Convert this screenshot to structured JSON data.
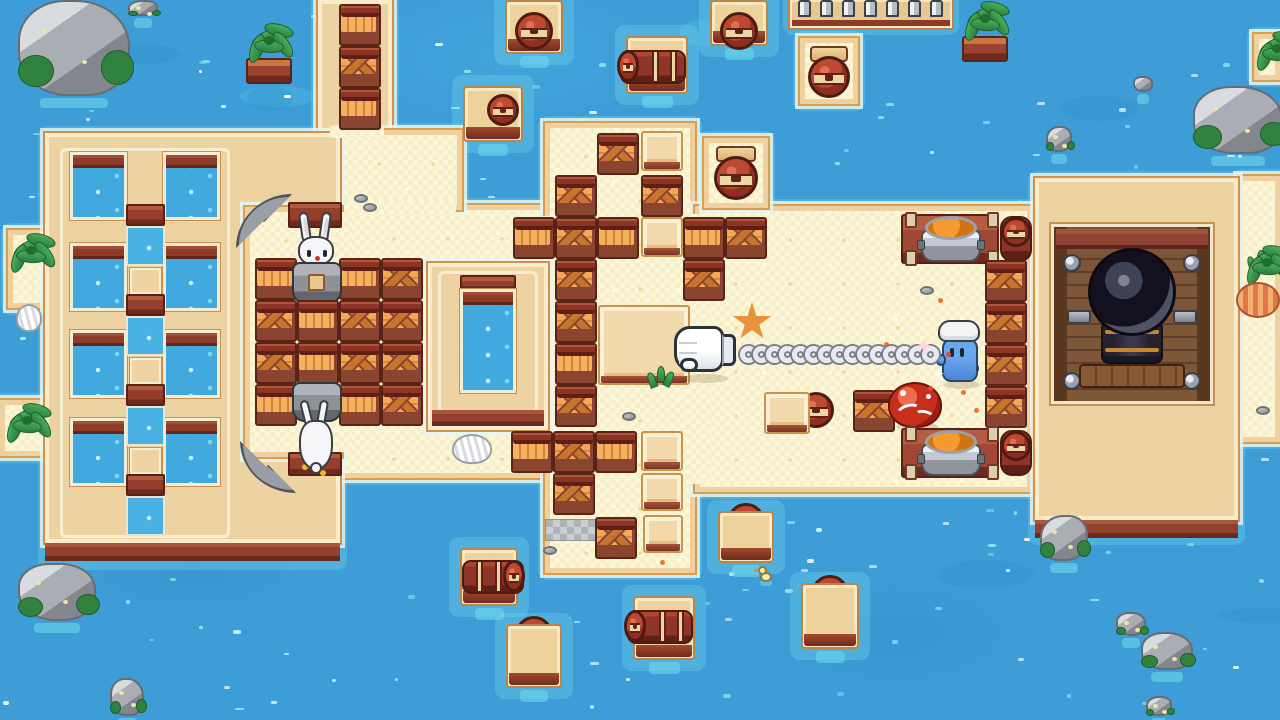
{
  "meta": {
    "scene": "pixel-art island battle arena over water",
    "hud_text": "none"
  },
  "palette": {
    "water": "#3e9dd6",
    "water_light": "#6ed0ea",
    "sand": "#f7efc8",
    "sand_edge": "#efd0a0",
    "platform_tan": "#eed3a2",
    "platform_border": "#f8eccb",
    "outline_orange": "#d2904a",
    "wall_red": "#93402e",
    "crate_frame": "#8a4530",
    "crate_plank": "#f0a452",
    "barrel_red": "#8e3428",
    "barrel_strap": "#ecd7a4",
    "rock_gray": "#aaadb3",
    "moss_green": "#31813f",
    "rabbit_white": "#f6f6f8",
    "chef_blue": "#5c9ee2",
    "crab_red": "#c62f1b",
    "soup_orange": "#f49a30",
    "cannon_dark": "#131020",
    "chain_silver": "#e8eaf0"
  },
  "land": {
    "sands": [
      [
        245,
        205,
        300,
        273
      ],
      [
        338,
        130,
        124,
        80
      ],
      [
        545,
        123,
        150,
        450
      ],
      [
        695,
        206,
        337,
        286
      ],
      [
        1238,
        176,
        42,
        266
      ]
    ],
    "sand_patches": [
      [
        538,
        216,
        20,
        256
      ],
      [
        686,
        214,
        26,
        270
      ],
      [
        344,
        200,
        112,
        16
      ],
      [
        330,
        126,
        54,
        12
      ],
      [
        334,
        212,
        18,
        240
      ]
    ],
    "pads": [
      [
        704,
        138,
        64,
        70
      ],
      [
        800,
        38,
        58,
        66
      ],
      [
        8,
        230,
        44,
        78
      ],
      [
        0,
        400,
        52,
        56
      ],
      [
        1254,
        34,
        26,
        46
      ]
    ],
    "notch": [
      245,
      207,
      97,
      250
    ],
    "dock": {
      "x": 45,
      "y": 133,
      "w": 295,
      "h": 410,
      "base_h": 18,
      "hole_cols": [
        70,
        163
      ],
      "hole_w": 57,
      "hole_h": 68,
      "hole_rows": [
        152,
        243,
        330,
        418
      ],
      "mid_col_x": 126,
      "mid_col_w": 39,
      "mid_y0": 204,
      "mid_cycles": 4,
      "inner_frame": [
        60,
        148,
        170,
        390
      ]
    },
    "causeway": {
      "x": 318,
      "y": 0,
      "w": 74,
      "h": 133
    },
    "pier": {
      "x": 790,
      "y": 0,
      "w": 162,
      "h": 28,
      "posts": 7
    },
    "right_platform": {
      "x": 1035,
      "y": 178,
      "w": 203,
      "h": 342,
      "base_h": 18
    },
    "pool_platform": {
      "x": 428,
      "y": 263,
      "w": 120,
      "h": 167,
      "pool": [
        460,
        275,
        56,
        118
      ],
      "base": [
        432,
        410,
        112,
        16
      ]
    }
  },
  "structures": {
    "cannon": {
      "x": 1051,
      "y": 224,
      "w": 162,
      "h": 180
    },
    "benches": [
      [
        901,
        214,
        98,
        50
      ],
      [
        901,
        428,
        98,
        50
      ]
    ],
    "cookpots": [
      [
        921,
        216,
        60,
        46
      ],
      [
        921,
        430,
        60,
        46
      ]
    ],
    "redwalls": [
      [
        288,
        202,
        54,
        26
      ],
      [
        288,
        452,
        54,
        24
      ]
    ],
    "pipes": [
      {
        "x": 236,
        "y": 194,
        "w": 56,
        "h": 54,
        "dir": "tl"
      },
      {
        "x": 240,
        "y": 441,
        "w": 56,
        "h": 52,
        "dir": "bl"
      }
    ],
    "graypad": [
      545,
      519,
      54,
      22
    ]
  },
  "entities": {
    "crates": [
      [
        339,
        4,
        "v"
      ],
      [
        339,
        46,
        "x"
      ],
      [
        339,
        88,
        "v"
      ],
      [
        255,
        258,
        "v"
      ],
      [
        339,
        258,
        "v"
      ],
      [
        381,
        258,
        "x"
      ],
      [
        255,
        300,
        "x"
      ],
      [
        297,
        300,
        "v"
      ],
      [
        339,
        300,
        "x"
      ],
      [
        381,
        300,
        "x"
      ],
      [
        255,
        342,
        "x"
      ],
      [
        297,
        342,
        "v"
      ],
      [
        339,
        342,
        "x"
      ],
      [
        381,
        342,
        "x"
      ],
      [
        255,
        384,
        "v"
      ],
      [
        339,
        384,
        "v"
      ],
      [
        381,
        384,
        "x"
      ],
      [
        597,
        133,
        "x"
      ],
      [
        555,
        175,
        "x"
      ],
      [
        641,
        175,
        "x"
      ],
      [
        513,
        217,
        "v"
      ],
      [
        555,
        217,
        "x"
      ],
      [
        597,
        217,
        "v"
      ],
      [
        683,
        217,
        "v"
      ],
      [
        725,
        217,
        "x"
      ],
      [
        555,
        259,
        "x"
      ],
      [
        683,
        259,
        "x"
      ],
      [
        555,
        301,
        "x"
      ],
      [
        555,
        343,
        "v"
      ],
      [
        555,
        385,
        "x"
      ],
      [
        511,
        431,
        "v"
      ],
      [
        553,
        431,
        "x"
      ],
      [
        595,
        431,
        "v"
      ],
      [
        553,
        473,
        "x"
      ],
      [
        595,
        517,
        "x"
      ],
      [
        853,
        390,
        "x"
      ],
      [
        985,
        260,
        "x"
      ],
      [
        985,
        302,
        "x"
      ],
      [
        985,
        344,
        "x"
      ],
      [
        985,
        386,
        "x"
      ]
    ],
    "blocks": [
      [
        641,
        131,
        42,
        40
      ],
      [
        641,
        217,
        42,
        40
      ],
      [
        641,
        431,
        42,
        40
      ],
      [
        641,
        473,
        42,
        38
      ],
      [
        643,
        515,
        40,
        38
      ],
      [
        598,
        305,
        92,
        80
      ],
      [
        764,
        392,
        46,
        42
      ]
    ],
    "rafts": [
      [
        505,
        0,
        58,
        54,
        "front-bottom"
      ],
      [
        463,
        86,
        60,
        56,
        "front-right"
      ],
      [
        626,
        36,
        62,
        58,
        "side-left"
      ],
      [
        710,
        0,
        58,
        46,
        "front-bottom"
      ],
      [
        460,
        548,
        58,
        58,
        "side-right"
      ],
      [
        506,
        624,
        56,
        64,
        "front-top"
      ],
      [
        633,
        596,
        62,
        64,
        "side-left"
      ],
      [
        718,
        511,
        56,
        52,
        "front-top"
      ],
      [
        801,
        583,
        58,
        66,
        "front-top"
      ]
    ],
    "upright_barrels": [
      [
        712,
        146,
        48,
        58
      ],
      [
        806,
        46,
        46,
        56
      ]
    ],
    "vert_barrels": [
      [
        1000,
        216,
        32,
        46
      ],
      [
        1000,
        430,
        32,
        46
      ]
    ],
    "lone_barrel_faces": [
      [
        798,
        392,
        36
      ]
    ],
    "rocks": [
      [
        18,
        0,
        112,
        96
      ],
      [
        128,
        0,
        30,
        16
      ],
      [
        1133,
        76,
        20,
        16
      ],
      [
        1193,
        86,
        90,
        68
      ],
      [
        1046,
        126,
        26,
        26
      ],
      [
        18,
        563,
        78,
        58
      ],
      [
        110,
        678,
        34,
        38
      ],
      [
        1040,
        515,
        48,
        46
      ],
      [
        1116,
        612,
        30,
        24
      ],
      [
        1141,
        632,
        52,
        38
      ],
      [
        1146,
        696,
        26,
        20
      ]
    ],
    "palms": [
      {
        "x": 242,
        "y": 22,
        "v": "planter"
      },
      {
        "x": 958,
        "y": 0,
        "v": "planter"
      },
      {
        "x": 4,
        "y": 232,
        "v": "sand"
      },
      {
        "x": 0,
        "y": 402,
        "v": "sand"
      },
      {
        "x": 1240,
        "y": 244,
        "v": "sand"
      },
      {
        "x": 1250,
        "y": 30,
        "v": "sand"
      }
    ],
    "characters": {
      "rabbit_sitting": [
        290,
        212
      ],
      "rabbit_diving": [
        290,
        382
      ],
      "chef": [
        936,
        320
      ],
      "crab": [
        888,
        382
      ]
    },
    "weapon": {
      "glove": [
        674,
        326
      ],
      "chain_y": 346,
      "chain_x1": 740,
      "chain_x2": 934,
      "links": 16
    },
    "props": {
      "starfish": [
        [
          732,
          302,
          40
        ]
      ],
      "sprouts": [
        [
          648,
          366
        ],
        [
          1248,
          250
        ]
      ],
      "shells_white": [
        [
          452,
          434,
          40,
          30
        ],
        [
          16,
          304,
          26,
          28
        ]
      ],
      "shells_pink": [
        [
          1236,
          282,
          44,
          36
        ]
      ],
      "duck": [
        758,
        566
      ],
      "pebbles": [
        [
          583,
          196
        ],
        [
          708,
          328
        ],
        [
          920,
          286
        ],
        [
          622,
          412
        ],
        [
          658,
          496
        ],
        [
          543,
          546
        ],
        [
          1256,
          406
        ],
        [
          354,
          194
        ],
        [
          363,
          203
        ]
      ],
      "spark_stars": [
        [
          916,
          338,
          16,
          "#ffd2e0"
        ],
        [
          933,
          368,
          11,
          "#ffffff"
        ]
      ],
      "red_dots": [
        [
          928,
          386
        ],
        [
          946,
          352
        ]
      ],
      "orange_dots": [
        [
          884,
          342
        ],
        [
          961,
          390
        ],
        [
          974,
          408
        ],
        [
          938,
          298
        ],
        [
          660,
          560
        ]
      ],
      "gold_dots": [
        [
          302,
          464
        ],
        [
          320,
          470
        ]
      ]
    }
  }
}
